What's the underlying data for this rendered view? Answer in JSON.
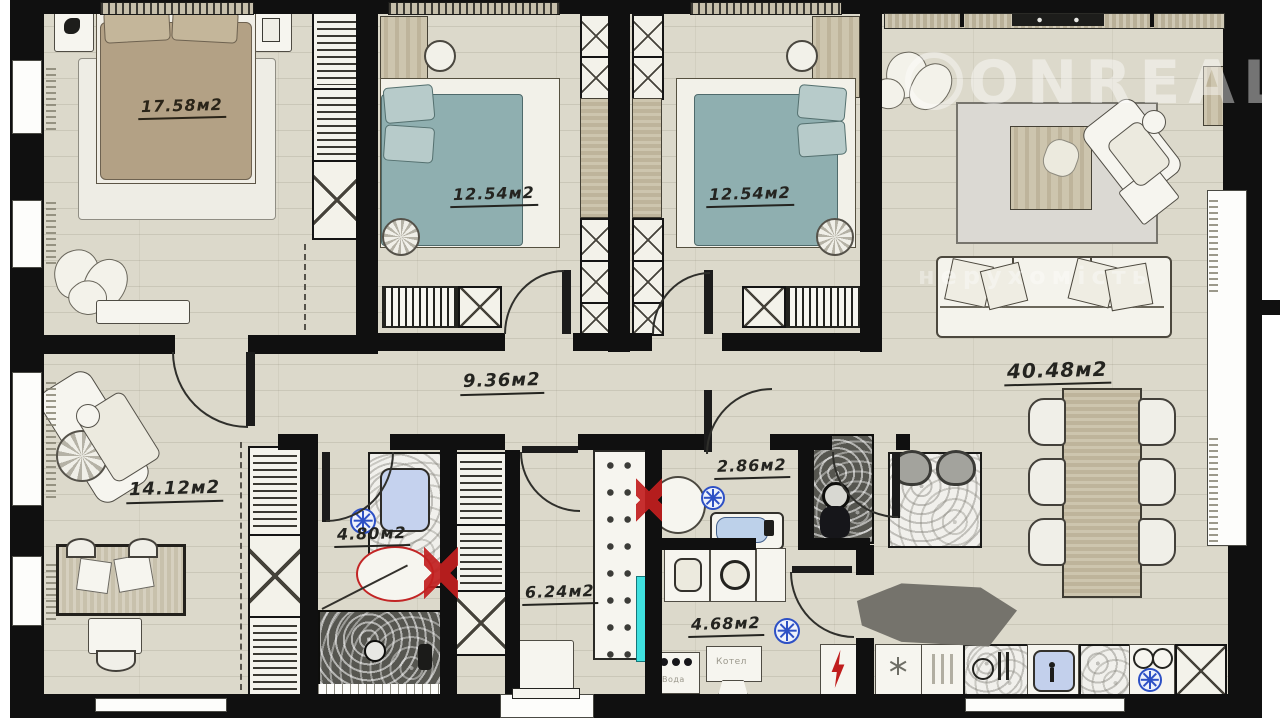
{
  "title": "apartment-floor-plan",
  "watermark": {
    "brand": "ONREAL",
    "tagline": "нерухомість"
  },
  "rooms": [
    {
      "name": "bedroom-1",
      "area": "17.58м2"
    },
    {
      "name": "bedroom-2",
      "area": "12.54м2"
    },
    {
      "name": "bedroom-3",
      "area": "12.54м2"
    },
    {
      "name": "living-kitchen",
      "area": "40.48м2"
    },
    {
      "name": "corridor",
      "area": "9.36м2"
    },
    {
      "name": "office-lounge",
      "area": "14.12м2"
    },
    {
      "name": "bathroom",
      "area": "4.80м2"
    },
    {
      "name": "shower-wc",
      "area": "2.86м2"
    },
    {
      "name": "entry-hall",
      "area": "6.24м2"
    },
    {
      "name": "laundry-boiler",
      "area": "4.68м2"
    }
  ],
  "equipment_labels": {
    "water": "Вода",
    "boiler": "Котел"
  },
  "icons": [
    "vent-fan-icon",
    "snowflake-icon",
    "lightning-icon",
    "red-plumbing-cross-icon",
    "washer-icon",
    "toilet-icon",
    "sink-icon",
    "bathtub-icon",
    "shower-icon",
    "sofa-icon",
    "bed-icon",
    "dining-table-icon",
    "plant-icon",
    "tv-icon"
  ],
  "colors": {
    "wall": "#101010",
    "floor": "#dcd9cb",
    "bed_brown": "#b3a185",
    "bed_teal": "#8fafb0",
    "accent_red": "#c21f1f",
    "accent_blue": "#2d50c5",
    "mirror_cyan": "#3fe0df",
    "sink_blue": "#c3d0ec"
  }
}
